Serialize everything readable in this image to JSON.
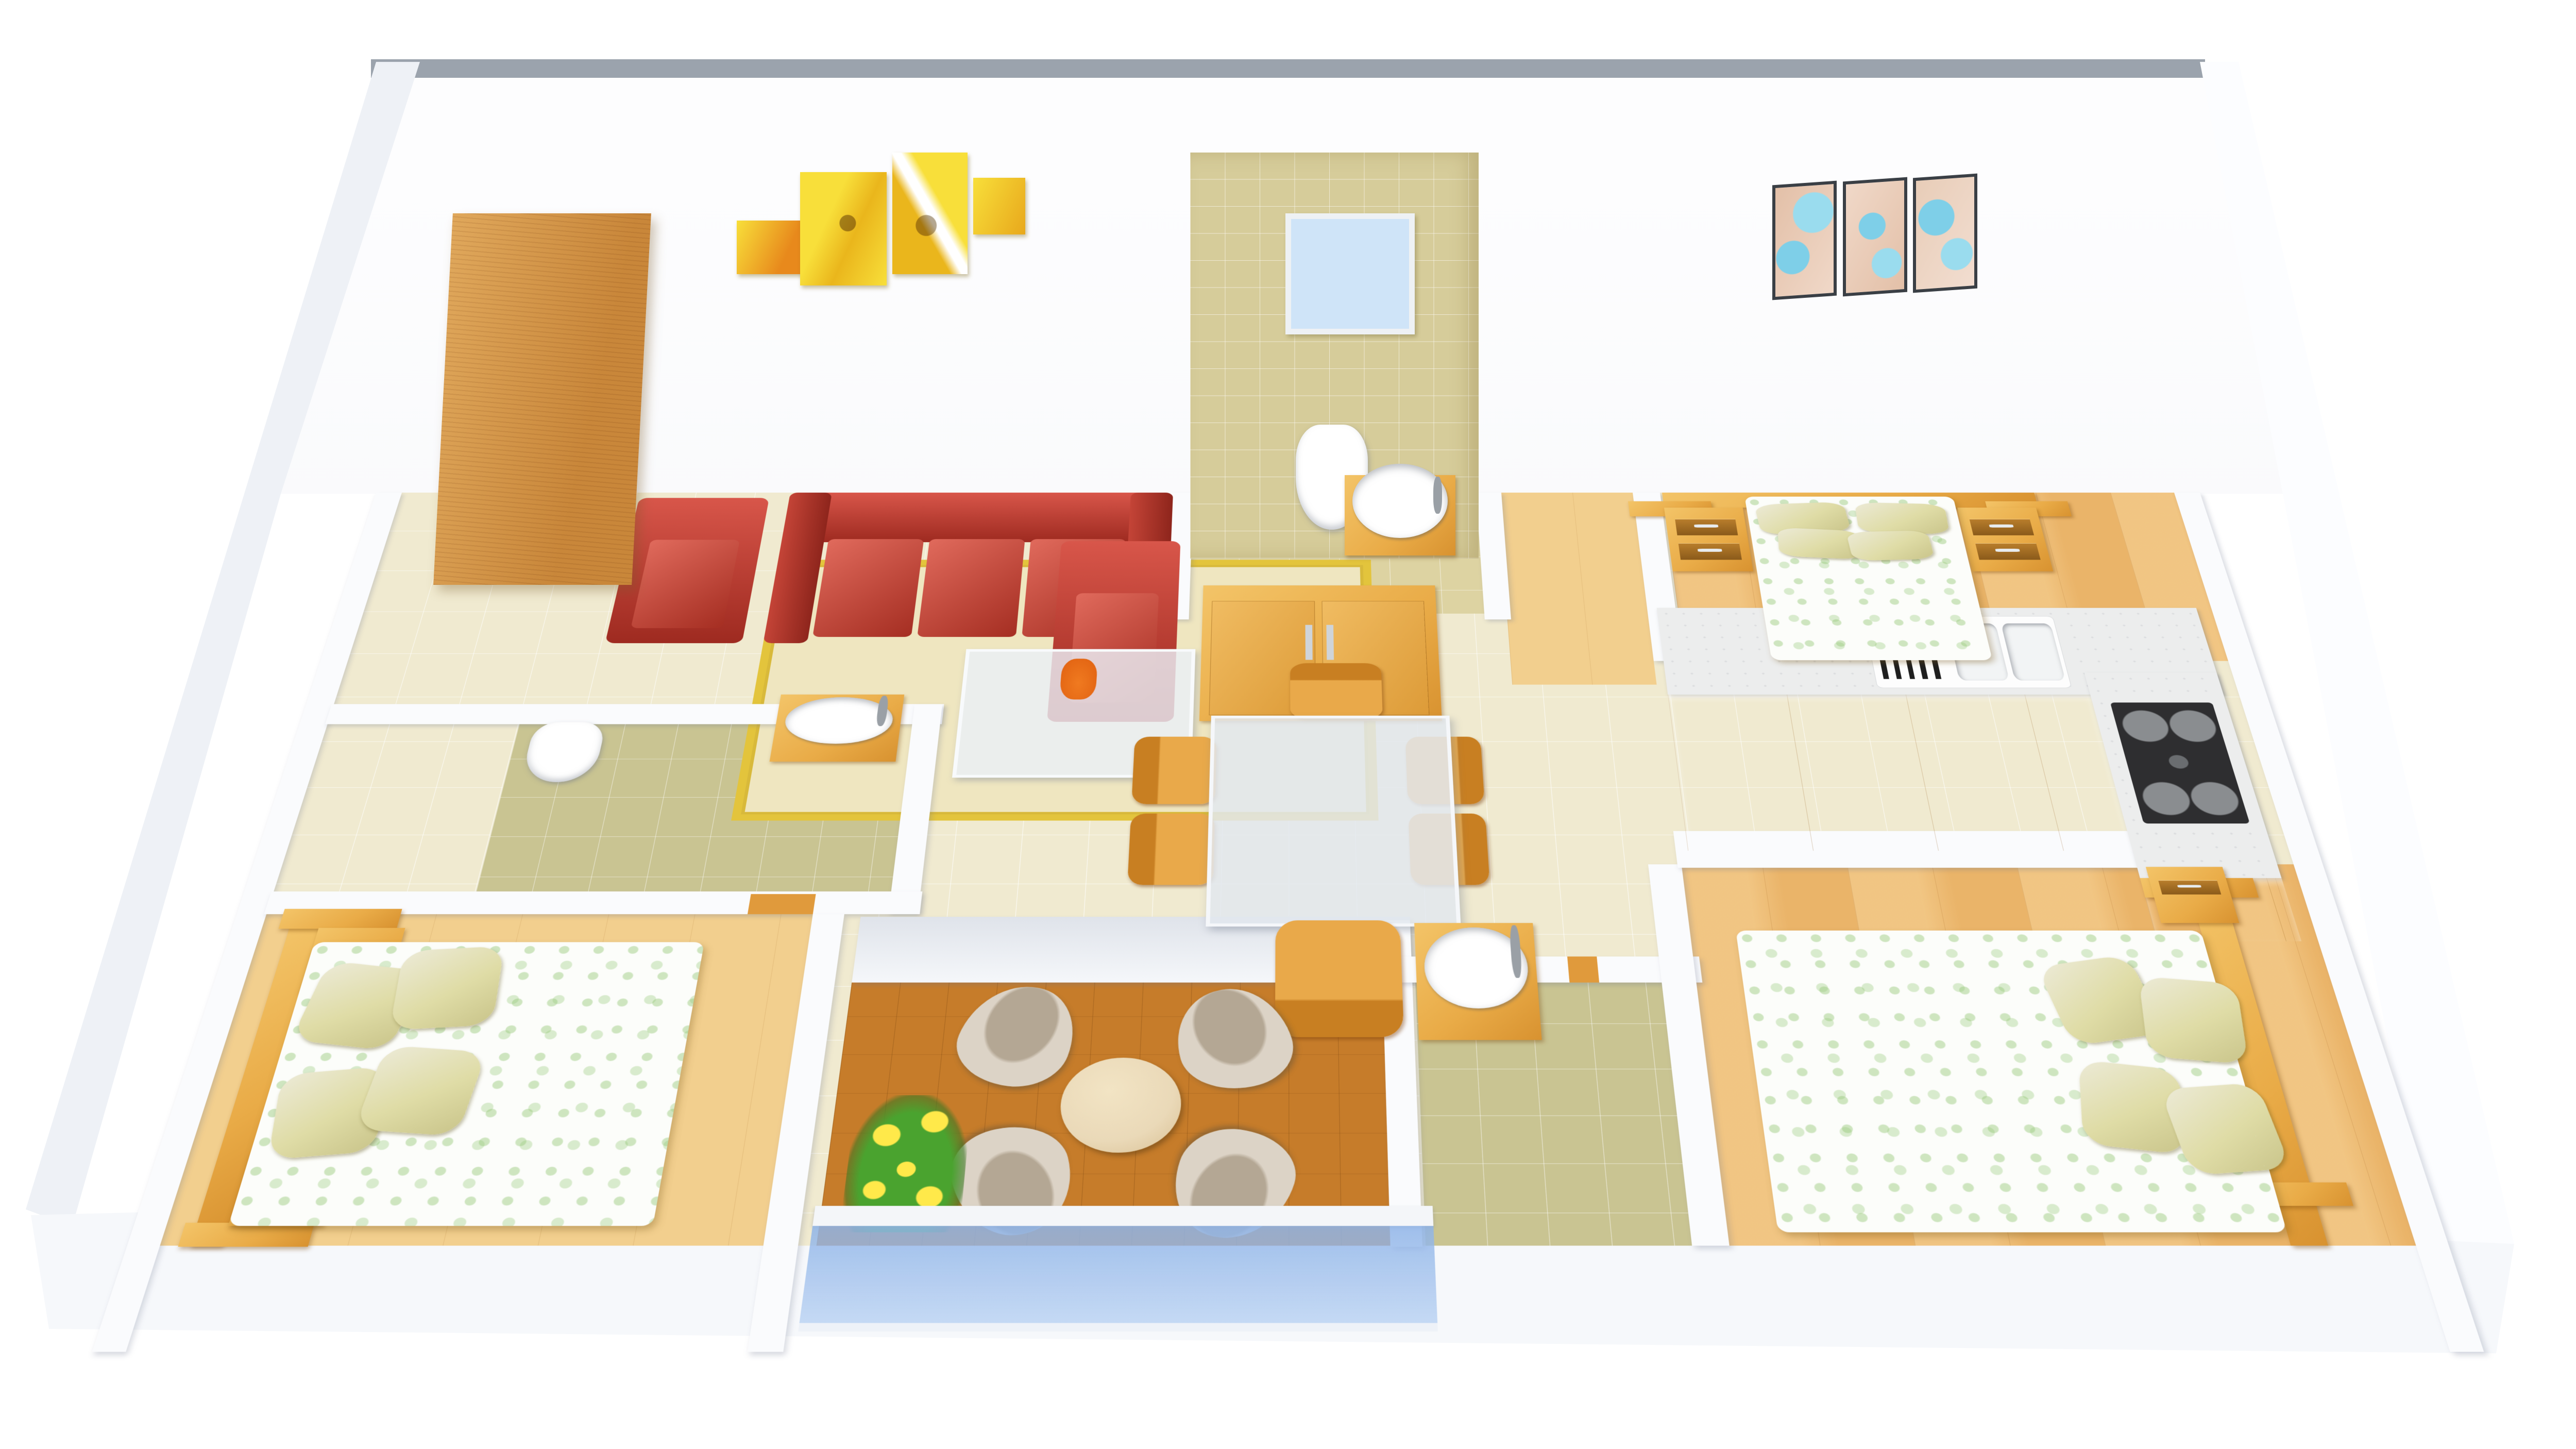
{
  "meta": {
    "title": "3D Apartment Floor Plan Render",
    "view": "isometric-top-down-3d-render",
    "background": "#ffffff"
  },
  "colors": {
    "wall-white": "#fafbfd",
    "wall-cap-gray": "#9ba3ad",
    "floor-beige-tile": "#f0ead0",
    "floor-tan-tile": "#ddd3a2",
    "floor-olive-tile": "#c9c492",
    "floor-wood": "#eab469",
    "floor-wood-light": "#f2cf8e",
    "floor-parquet": "#c67c2a",
    "furniture-wood": "#e9ab47",
    "cabinet-orange": "#f0a239",
    "sofa-red": "#b5372b",
    "pillow-green": "#dfdca6",
    "duvet-white": "#fcfdfa",
    "counter-marble": "#eceded",
    "railing-glass": "#8fb4e8",
    "art-yellow": "#f2c91e",
    "art-blue": "#8fd8ea",
    "vase-orange": "#e06010",
    "flower-yellow": "#ffe94a",
    "leaf-green": "#4aa32f",
    "hob-dark": "#2e2e30",
    "window-blue": "#cfe4f8",
    "door-wood": "#d99b4e"
  },
  "rooms": [
    {
      "name": "living-room",
      "floor": "beige-tile",
      "items": [
        "leaning-door-panel",
        "yellow-abstract-wall-art",
        "red-leather-sofa-3-seat",
        "red-armchair-left",
        "red-armchair-right",
        "glass-coffee-table",
        "orange-vase",
        "yellow-bordered-rug"
      ]
    },
    {
      "name": "hallway-dining-area",
      "floor": "beige-tile",
      "items": [
        "glass-top-dining-table",
        "six-wooden-dining-chairs",
        "wooden-sideboard-cabinet"
      ]
    },
    {
      "name": "bathroom-top",
      "floor": "tan-tile",
      "items": [
        "tiled-wall-with-window",
        "wall-hung-toilet",
        "round-washbasin-on-wooden-stand"
      ]
    },
    {
      "name": "master-bedroom",
      "floor": "wood",
      "items": [
        "double-bed-with-wooden-headboard",
        "four-green-pillows",
        "green-patterned-duvet",
        "two-nightstands-with-drawers"
      ]
    },
    {
      "name": "kitchen",
      "floor": "wood",
      "items": [
        "l-shaped-marble-counter",
        "double-sink-with-drainboard",
        "four-burner-gas-hob",
        "orange-base-cabinets"
      ]
    },
    {
      "name": "bathroom-middle-left",
      "floor": "olive-tile",
      "items": [
        "toilet",
        "round-washbasin-on-wooden-counter"
      ]
    },
    {
      "name": "bedroom-left",
      "floor": "wood",
      "items": [
        "double-bed-with-wooden-headboard",
        "four-green-pillows",
        "green-patterned-duvet",
        "two-nightstands"
      ]
    },
    {
      "name": "balcony",
      "floor": "dark-parquet",
      "items": [
        "four-fabric-lounge-chairs",
        "round-wooden-side-table",
        "yellow-flower-planter",
        "blue-glass-railing"
      ]
    },
    {
      "name": "bathroom-bottom",
      "floor": "olive-tile",
      "items": [
        "round-washbasin-on-wooden-stand"
      ]
    },
    {
      "name": "bedroom-right",
      "floor": "wood",
      "items": [
        "double-bed-with-wooden-headboard",
        "four-green-pillows",
        "green-patterned-duvet",
        "nightstand"
      ]
    }
  ],
  "wall_decor": [
    "wooden-door-panel-leaning-on-back-wall",
    "yellow-four-panel-abstract-swirl-art",
    "blue-swirl-triptych-art",
    "tan-tiled-bathroom-wall-with-window"
  ],
  "counts": {
    "bedrooms": 3,
    "bathrooms": 3,
    "balconies": 1,
    "beds": 3,
    "dining-chairs": 6,
    "balcony-chairs": 4,
    "washbasins": 3,
    "toilets": 2,
    "sofas": 1,
    "armchairs": 2
  }
}
